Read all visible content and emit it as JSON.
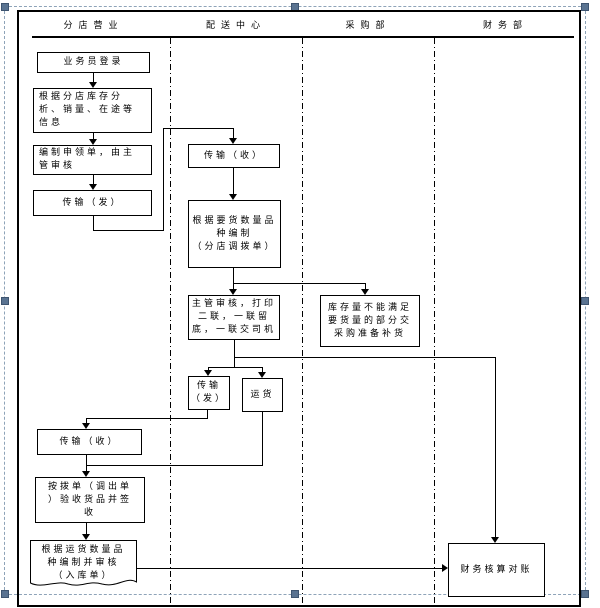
{
  "colors": {
    "line": "#000000",
    "selection_border": "#8ea3b8",
    "selection_handle": "#5a7391",
    "background": "#ffffff"
  },
  "lanes": [
    {
      "id": "branch",
      "label": "分店营业"
    },
    {
      "id": "distribution",
      "label": "配送中心"
    },
    {
      "id": "purchasing",
      "label": "采购部"
    },
    {
      "id": "finance",
      "label": "财务部"
    }
  ],
  "nodes": {
    "login": {
      "text": "业务员登录",
      "lane": "branch"
    },
    "analyze": {
      "lines": [
        "根据分店库存分",
        "析、销量、在途等",
        "信息"
      ],
      "lane": "branch"
    },
    "prepare": {
      "lines": [
        "编制申领单，由主",
        "管审核"
      ],
      "lane": "branch"
    },
    "send1": {
      "text": "传输（发）",
      "lane": "branch"
    },
    "recv1": {
      "text": "传输（收）",
      "lane": "distribution"
    },
    "make_transfer": {
      "lines": [
        "根据要货数量品",
        "种编制",
        "（分店调拨单）"
      ],
      "lane": "distribution"
    },
    "review_print": {
      "lines": [
        "主管审核，打印",
        "二联，一联留",
        "底，一联交司机"
      ],
      "lane": "distribution"
    },
    "shortage": {
      "lines": [
        "库存量不能满足",
        "要货量的部分交",
        "采购准备补货"
      ],
      "lane": "purchasing"
    },
    "send2": {
      "lines": [
        "传输",
        "（发）"
      ],
      "lane": "distribution"
    },
    "ship": {
      "text": "运货",
      "lane": "distribution"
    },
    "recv2": {
      "text": "传输（收）",
      "lane": "branch"
    },
    "inspect": {
      "lines": [
        "按拨单（调出单",
        "）验收货品并签",
        "收"
      ],
      "lane": "branch"
    },
    "warehouse_doc": {
      "lines": [
        "根据运货数量品",
        "种编制并审核",
        "（入库单）"
      ],
      "lane": "branch"
    },
    "reconcile": {
      "text": "财务核算对账",
      "lane": "finance"
    }
  },
  "edges": [
    {
      "from": "login",
      "to": "analyze"
    },
    {
      "from": "analyze",
      "to": "prepare"
    },
    {
      "from": "prepare",
      "to": "send1"
    },
    {
      "from": "send1",
      "to": "recv1"
    },
    {
      "from": "recv1",
      "to": "make_transfer"
    },
    {
      "from": "make_transfer",
      "to": "review_print"
    },
    {
      "from": "make_transfer",
      "to": "shortage"
    },
    {
      "from": "review_print",
      "to": "send2"
    },
    {
      "from": "review_print",
      "to": "ship"
    },
    {
      "from": "review_print",
      "to": "reconcile"
    },
    {
      "from": "send2",
      "to": "recv2"
    },
    {
      "from": "recv2",
      "to": "inspect"
    },
    {
      "from": "ship",
      "to": "inspect"
    },
    {
      "from": "inspect",
      "to": "warehouse_doc"
    },
    {
      "from": "warehouse_doc",
      "to": "reconcile"
    }
  ]
}
